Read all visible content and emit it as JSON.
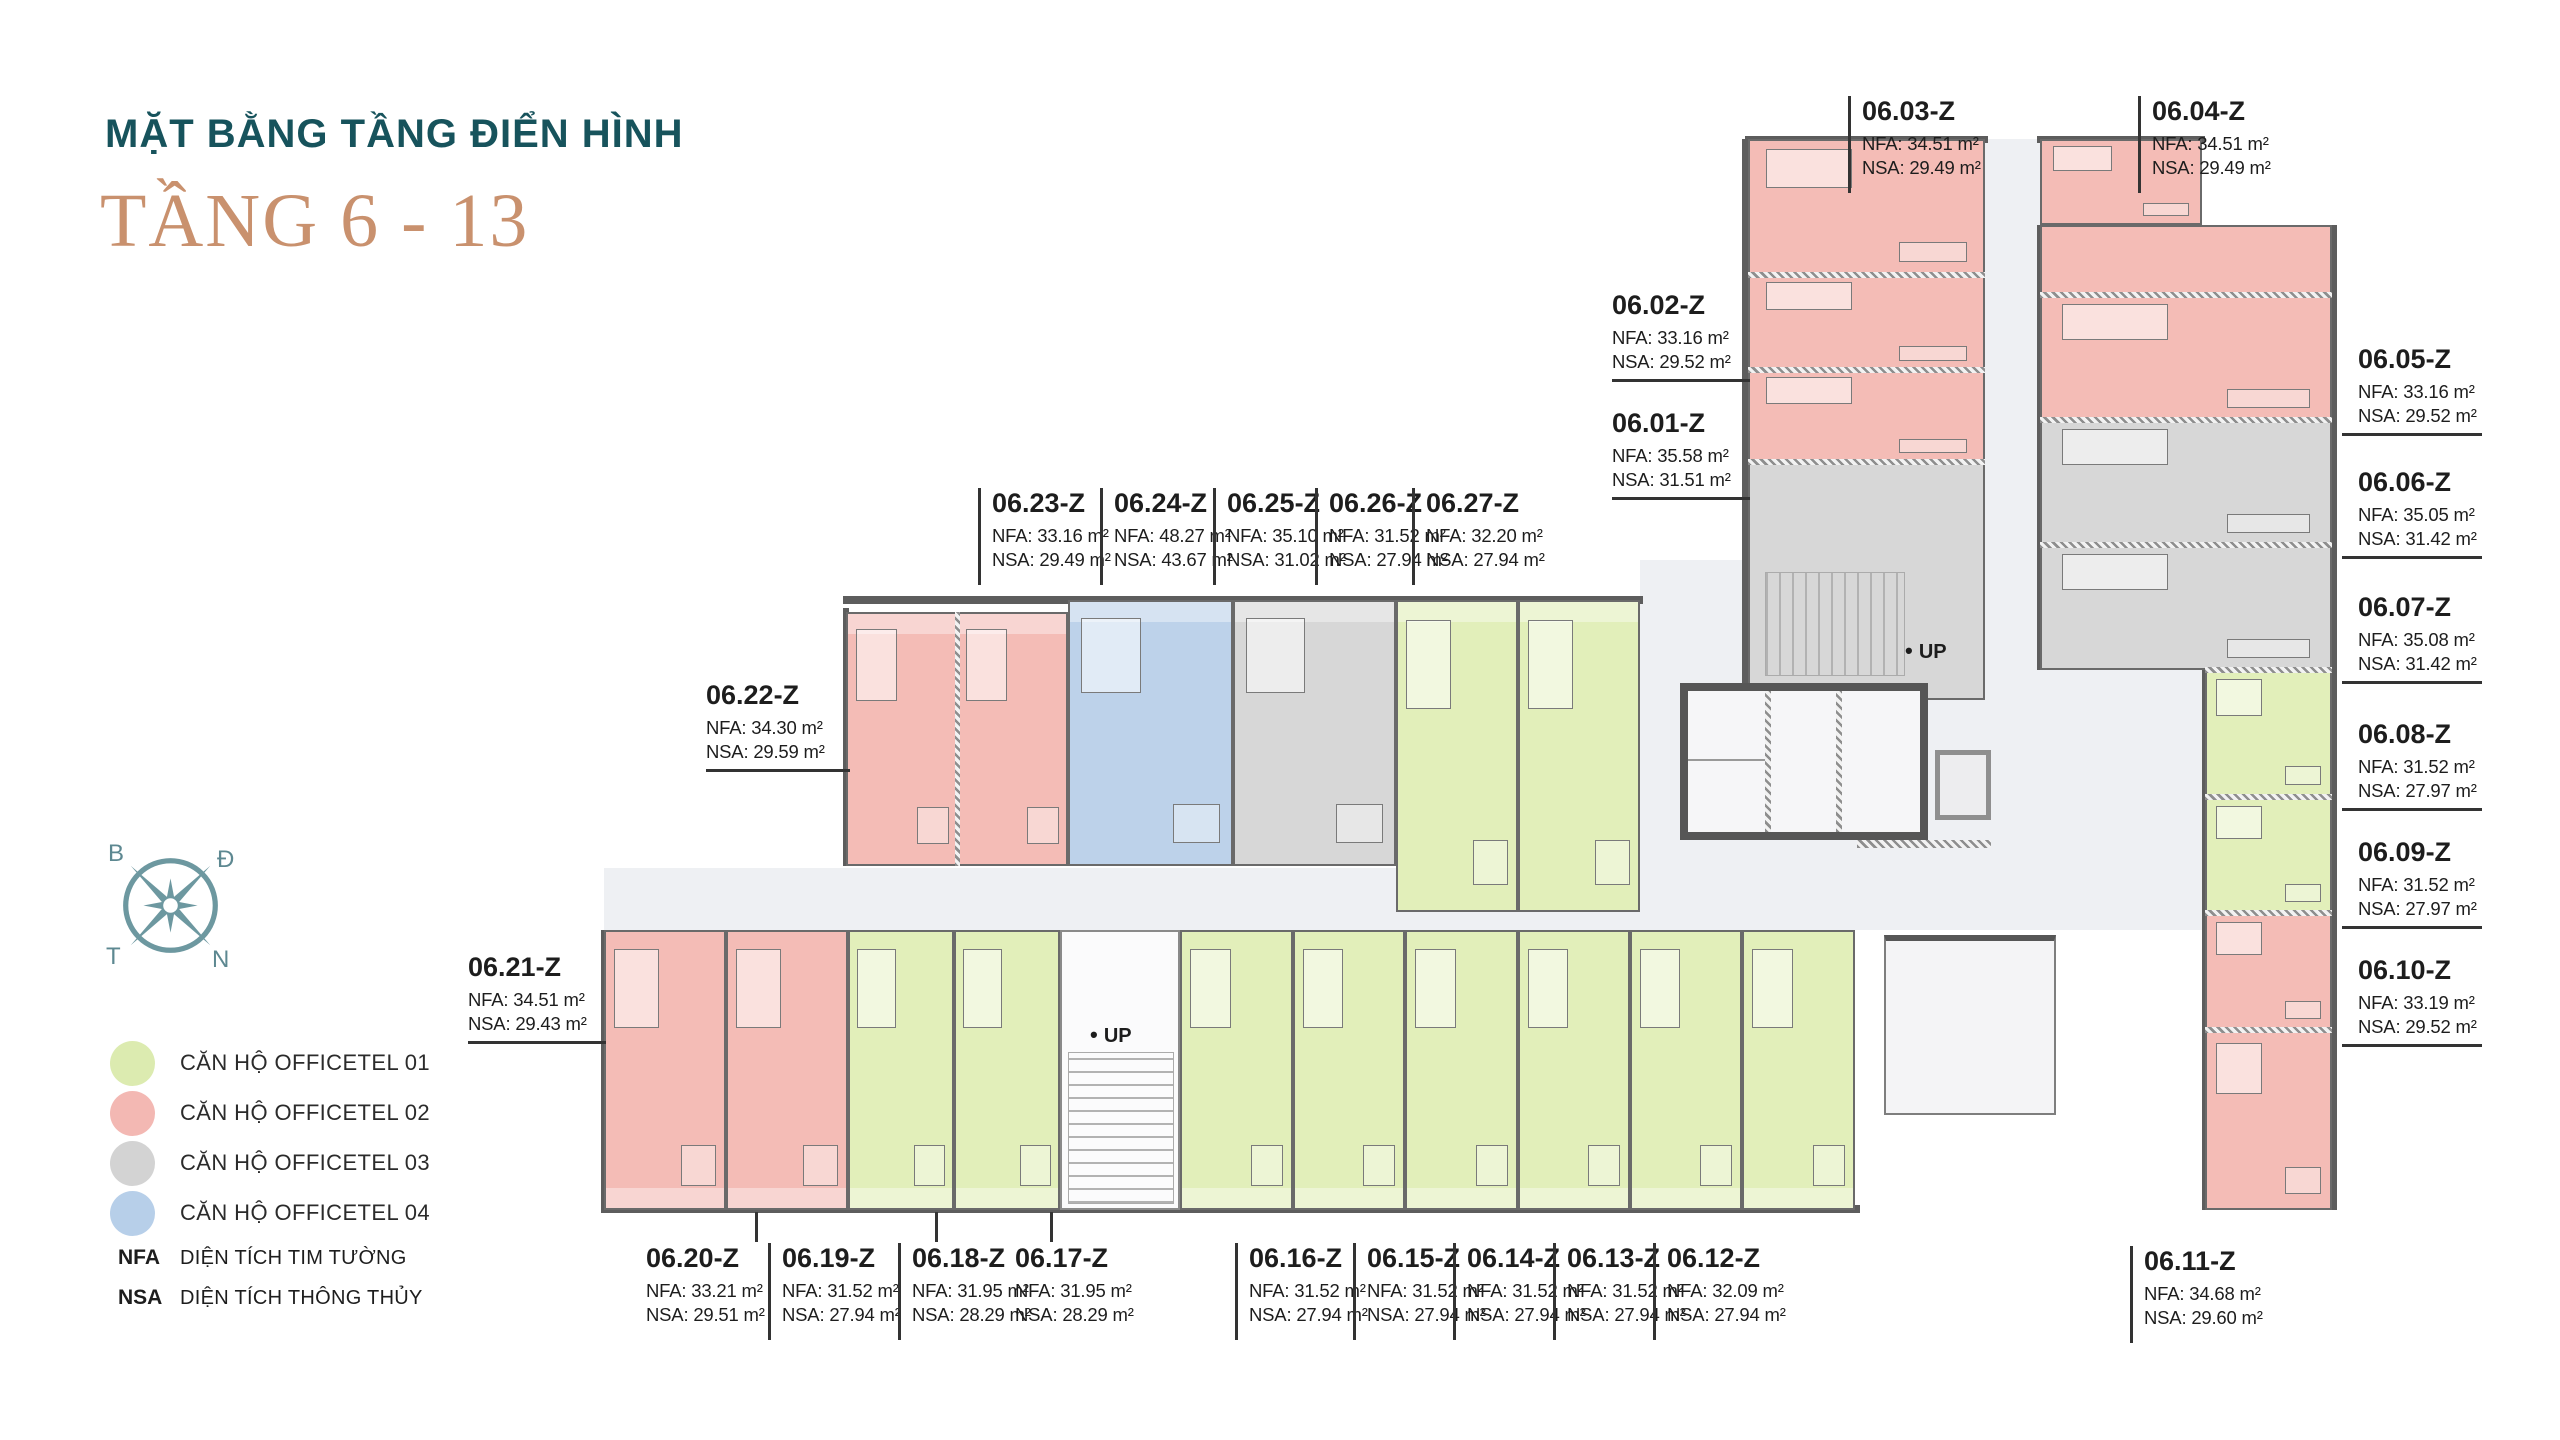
{
  "page": {
    "title": "MẶT BẰNG TẦNG ĐIỂN HÌNH",
    "subtitle": "TẦNG 6 - 13",
    "title_color": "#17535c",
    "subtitle_color": "#c9916e"
  },
  "compass": {
    "labels": {
      "top_left": "B",
      "top_right": "Đ",
      "bottom_left": "T",
      "bottom_right": "N"
    }
  },
  "legend": {
    "items": [
      {
        "label": "CĂN HỘ OFFICETEL 01",
        "color": "#dcebb0"
      },
      {
        "label": "CĂN HỘ OFFICETEL 02",
        "color": "#f3b8b3"
      },
      {
        "label": "CĂN HỘ OFFICETEL 03",
        "color": "#d3d3d3"
      },
      {
        "label": "CĂN HỘ OFFICETEL 04",
        "color": "#b7cfe9"
      }
    ],
    "abbreviations": [
      {
        "abbr": "NFA",
        "label": "DIỆN TÍCH TIM TƯỜNG"
      },
      {
        "abbr": "NSA",
        "label": "DIỆN TÍCH THÔNG THỦY"
      }
    ]
  },
  "plan": {
    "up_label": "UP",
    "units": [
      {
        "code": "06.01-Z",
        "nfa": "NFA: 35.58 m²",
        "nsa": "NSA: 31.51 m²"
      },
      {
        "code": "06.02-Z",
        "nfa": "NFA: 33.16 m²",
        "nsa": "NSA: 29.52 m²"
      },
      {
        "code": "06.03-Z",
        "nfa": "NFA: 34.51 m²",
        "nsa": "NSA: 29.49 m²"
      },
      {
        "code": "06.04-Z",
        "nfa": "NFA: 34.51 m²",
        "nsa": "NSA: 29.49 m²"
      },
      {
        "code": "06.05-Z",
        "nfa": "NFA: 33.16 m²",
        "nsa": "NSA: 29.52 m²"
      },
      {
        "code": "06.06-Z",
        "nfa": "NFA: 35.05 m²",
        "nsa": "NSA: 31.42 m²"
      },
      {
        "code": "06.07-Z",
        "nfa": "NFA: 35.08 m²",
        "nsa": "NSA: 31.42 m²"
      },
      {
        "code": "06.08-Z",
        "nfa": "NFA: 31.52 m²",
        "nsa": "NSA: 27.97 m²"
      },
      {
        "code": "06.09-Z",
        "nfa": "NFA: 31.52 m²",
        "nsa": "NSA: 27.97 m²"
      },
      {
        "code": "06.10-Z",
        "nfa": "NFA: 33.19 m²",
        "nsa": "NSA: 29.52 m²"
      },
      {
        "code": "06.11-Z",
        "nfa": "NFA: 34.68 m²",
        "nsa": "NSA: 29.60 m²"
      },
      {
        "code": "06.12-Z",
        "nfa": "NFA: 32.09 m²",
        "nsa": "NSA: 27.94 m²"
      },
      {
        "code": "06.13-Z",
        "nfa": "NFA: 31.52 m²",
        "nsa": "NSA: 27.94 m²"
      },
      {
        "code": "06.14-Z",
        "nfa": "NFA: 31.52 m²",
        "nsa": "NSA: 27.94 m²"
      },
      {
        "code": "06.15-Z",
        "nfa": "NFA: 31.52 m²",
        "nsa": "NSA: 27.94 m²"
      },
      {
        "code": "06.16-Z",
        "nfa": "NFA: 31.52 m²",
        "nsa": "NSA: 27.94 m²"
      },
      {
        "code": "06.17-Z",
        "nfa": "NFA: 31.95 m²",
        "nsa": "NSA: 28.29 m²"
      },
      {
        "code": "06.18-Z",
        "nfa": "NFA: 31.95 m²",
        "nsa": "NSA: 28.29 m²"
      },
      {
        "code": "06.19-Z",
        "nfa": "NFA: 31.52 m²",
        "nsa": "NSA: 27.94 m²"
      },
      {
        "code": "06.20-Z",
        "nfa": "NFA: 33.21 m²",
        "nsa": "NSA: 29.51 m²"
      },
      {
        "code": "06.21-Z",
        "nfa": "NFA: 34.51 m²",
        "nsa": "NSA: 29.43 m²"
      },
      {
        "code": "06.22-Z",
        "nfa": "NFA: 34.30 m²",
        "nsa": "NSA: 29.59 m²"
      },
      {
        "code": "06.23-Z",
        "nfa": "NFA: 33.16 m²",
        "nsa": "NSA: 29.49 m²"
      },
      {
        "code": "06.24-Z",
        "nfa": "NFA: 48.27 m²",
        "nsa": "NSA: 43.67 m²"
      },
      {
        "code": "06.25-Z",
        "nfa": "NFA: 35.10 m²",
        "nsa": "NSA: 31.02 m²"
      },
      {
        "code": "06.26-Z",
        "nfa": "NFA: 31.52 m²",
        "nsa": "NSA: 27.94 m²"
      },
      {
        "code": "06.27-Z",
        "nfa": "NFA: 32.20 m²",
        "nsa": "NSA: 27.94 m²"
      }
    ]
  }
}
